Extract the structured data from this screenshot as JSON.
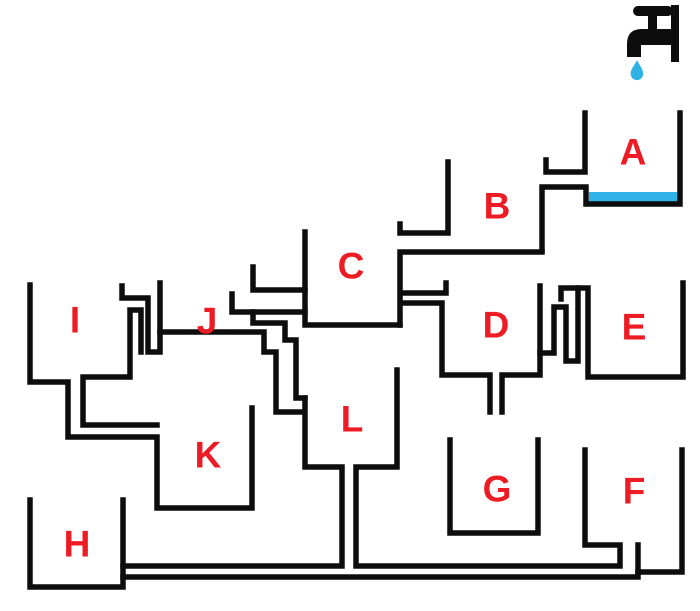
{
  "title": "Water tap container puzzle diagram",
  "colors": {
    "line_black": "#0d0d0d",
    "letter_red": "#ed1c24",
    "water_blue": "#2fb2e5",
    "background": "#ffffff"
  },
  "tap": {
    "icon": "faucet-icon",
    "position": "top-right"
  },
  "drop": {
    "icon": "water-drop-icon"
  },
  "water": {
    "filled_container": "A"
  },
  "labels": {
    "a": "A",
    "b": "B",
    "c": "C",
    "d": "D",
    "e": "E",
    "f": "F",
    "g": "G",
    "h": "H",
    "i": "I",
    "j": "J",
    "k": "K",
    "l": "L"
  },
  "label_positions": {
    "a": [
      633,
      152
    ],
    "b": [
      497,
      206
    ],
    "c": [
      351,
      266
    ],
    "d": [
      496,
      325
    ],
    "e": [
      634,
      327
    ],
    "f": [
      634,
      491
    ],
    "g": [
      497,
      489
    ],
    "h": [
      77,
      544
    ],
    "i": [
      75,
      320
    ],
    "j": [
      207,
      321
    ],
    "k": [
      208,
      455
    ],
    "l": [
      352,
      419
    ]
  }
}
